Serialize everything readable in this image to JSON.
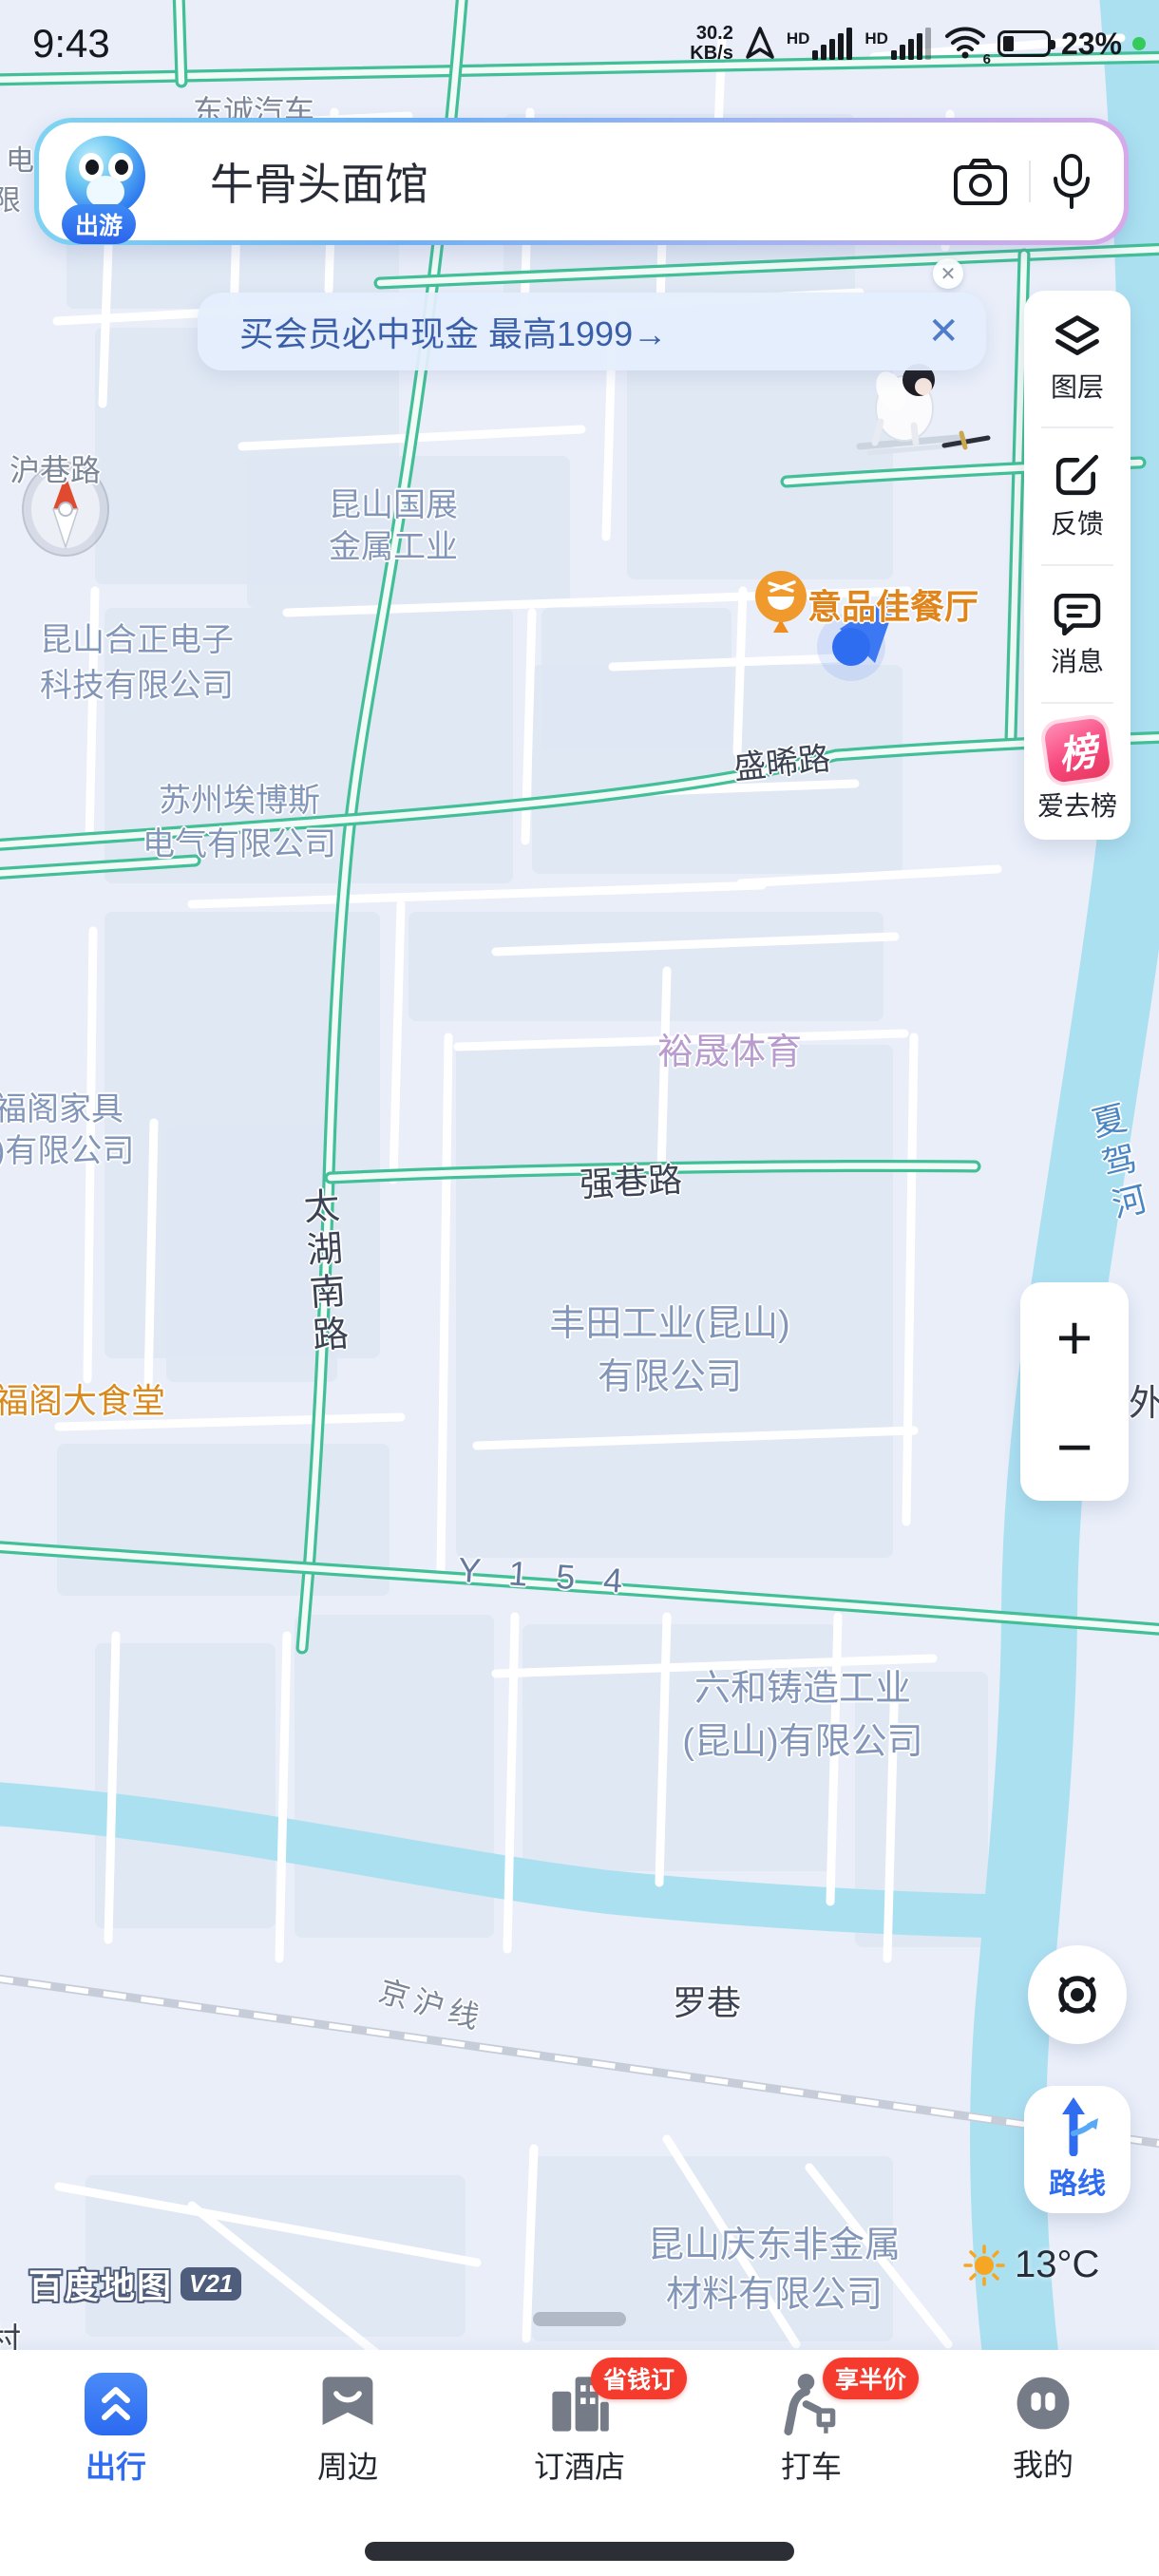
{
  "status_bar": {
    "time": "9:43",
    "net_speed_value": "30.2",
    "net_speed_unit": "KB/s",
    "hd1": "HD",
    "hd2": "HD",
    "wifi_number": "6",
    "battery_percent": "23%",
    "icons": [
      "gps-arrow-icon",
      "signal-bars-icon",
      "signal-bars-icon",
      "wifi-icon",
      "battery-icon",
      "camera-indicator-dot"
    ]
  },
  "search": {
    "mascot_badge": "出游",
    "query": "牛骨头面馆",
    "camera_icon": "camera-icon",
    "mic_icon": "microphone-icon"
  },
  "banner": {
    "text": "买会员必中现金 最高1999→",
    "close": "✕",
    "mini_close": "✕"
  },
  "side_panel": {
    "items": [
      {
        "label": "图层",
        "icon": "layers-icon"
      },
      {
        "label": "反馈",
        "icon": "feedback-edit-icon"
      },
      {
        "label": "消息",
        "icon": "message-bubble-icon"
      },
      {
        "label": "爱去榜",
        "icon": "bang-ranking-icon",
        "badge_char": "榜"
      }
    ]
  },
  "map": {
    "labels": [
      {
        "text": "沪巷路"
      },
      {
        "text": "东诚汽车"
      },
      {
        "text": "昆山国展\n金属工业"
      },
      {
        "text": "昆山合正电子\n科技有限公司"
      },
      {
        "text": "苏州埃博斯\n电气有限公司"
      },
      {
        "text": "意品佳餐厅"
      },
      {
        "text": "盛晞路"
      },
      {
        "text": "裕晟体育"
      },
      {
        "text": "福阁家具\n)有限公司"
      },
      {
        "text": "强巷路"
      },
      {
        "text": "夏驾河"
      },
      {
        "text": "太湖南路"
      },
      {
        "text": "丰田工业(昆山)\n有限公司"
      },
      {
        "text": "福阁大食堂"
      },
      {
        "text": "外"
      },
      {
        "text": "Y 1 5 4"
      },
      {
        "text": "六和铸造工业\n(昆山)有限公司"
      },
      {
        "text": "京沪线"
      },
      {
        "text": "罗巷"
      },
      {
        "text": "昆山庆东非金属\n材料有限公司"
      },
      {
        "text": "电"
      },
      {
        "text": "限"
      },
      {
        "text": "村"
      }
    ],
    "colors": {
      "road_green": "#43bf97",
      "river_blue": "#abe0f1",
      "company_label": "#8296ba",
      "poi_orange": "#e0851c",
      "sports_purple": "#b79ccd",
      "river_label": "#4b86c4"
    }
  },
  "controls": {
    "zoom_in": "+",
    "zoom_out": "−",
    "route_label": "路线",
    "locate_icon": "crosshair-target-icon",
    "compass_icon": "compass-needle-icon"
  },
  "weather": {
    "temperature": "13°C",
    "icon": "sun-icon"
  },
  "attribution": {
    "brand": "百度地图",
    "version": "V21"
  },
  "bottom_nav": {
    "items": [
      {
        "label": "出行",
        "active": true,
        "icon": "trip-chevrons-icon"
      },
      {
        "label": "周边",
        "active": false,
        "icon": "nearby-badge-icon"
      },
      {
        "label": "订酒店",
        "active": false,
        "icon": "hotel-buildings-icon",
        "badge": "省钱订"
      },
      {
        "label": "打车",
        "active": false,
        "icon": "taxi-person-icon",
        "badge": "享半价"
      },
      {
        "label": "我的",
        "active": false,
        "icon": "profile-face-icon"
      }
    ]
  }
}
